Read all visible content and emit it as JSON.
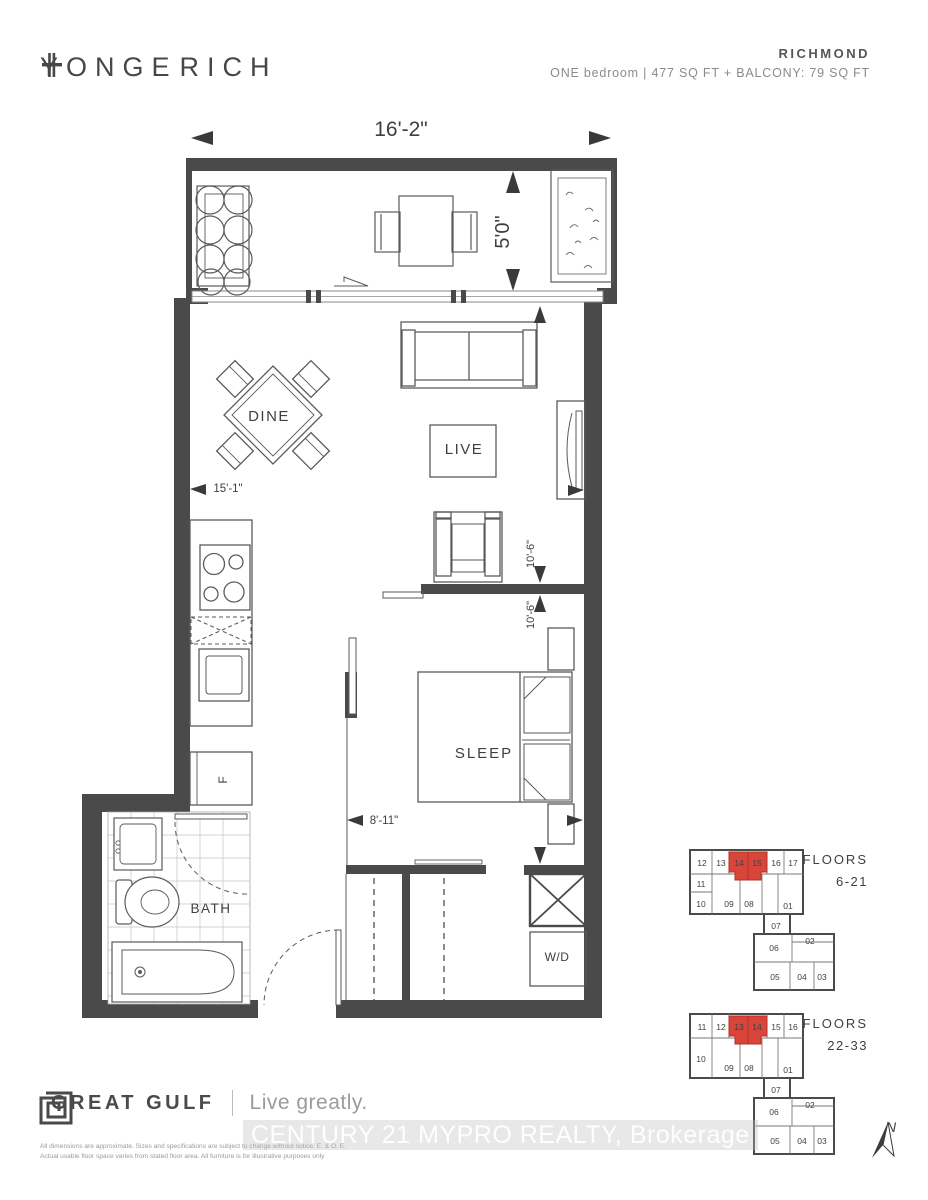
{
  "header": {
    "logo_word1": "YONGE",
    "logo_word2": "RICH",
    "unit_name": "RICHMOND",
    "unit_specs": "ONE bedroom  |  477 SQ FT  +  BALCONY: 79 SQ FT"
  },
  "plan": {
    "room_labels": {
      "dining": "DINE",
      "living": "LIVE",
      "bedroom": "SLEEP",
      "bathroom": "BATH",
      "laundry": "W/D",
      "fridge": "F"
    },
    "dimensions": {
      "overall_width": "16'-2\"",
      "balcony_depth": "5'0\"",
      "living_length": "15'-1\"",
      "living_width": "10'-6\"",
      "bedroom_width": "10'-6\"",
      "bedroom_length": "8'-11\""
    }
  },
  "keyplans": [
    {
      "floors_word": "FLOORS",
      "floors_range": "6-21",
      "row1": [
        "12",
        "13",
        "16",
        "17"
      ],
      "highlighted": [
        "14",
        "15"
      ],
      "row2": [
        "11",
        "10",
        "09",
        "08",
        "01"
      ],
      "lower": [
        "07",
        "06",
        "02",
        "05",
        "04",
        "03"
      ]
    },
    {
      "floors_word": "FLOORS",
      "floors_range": "22-33",
      "row1": [
        "11",
        "12",
        "15",
        "16"
      ],
      "highlighted": [
        "13",
        "14"
      ],
      "row2": [
        "10",
        "09",
        "08",
        "01"
      ],
      "lower": [
        "07",
        "06",
        "02",
        "05",
        "04",
        "03"
      ]
    }
  ],
  "compass": {
    "north_label": "N"
  },
  "footer": {
    "brand": "GREAT GULF",
    "tagline": "Live greatly.",
    "disclaimer_line1": "All dimensions are approximate. Sizes and specifications are subject to change without notice. E. & O. E.",
    "disclaimer_line2": "Actual usable floor space varies from stated floor area. All furniture is for illustrative purposes only",
    "watermark": "CENTURY 21 MYPRO REALTY, Brokerage"
  },
  "colors": {
    "wall": "#4a4a4a",
    "highlight": "#d9453b"
  }
}
